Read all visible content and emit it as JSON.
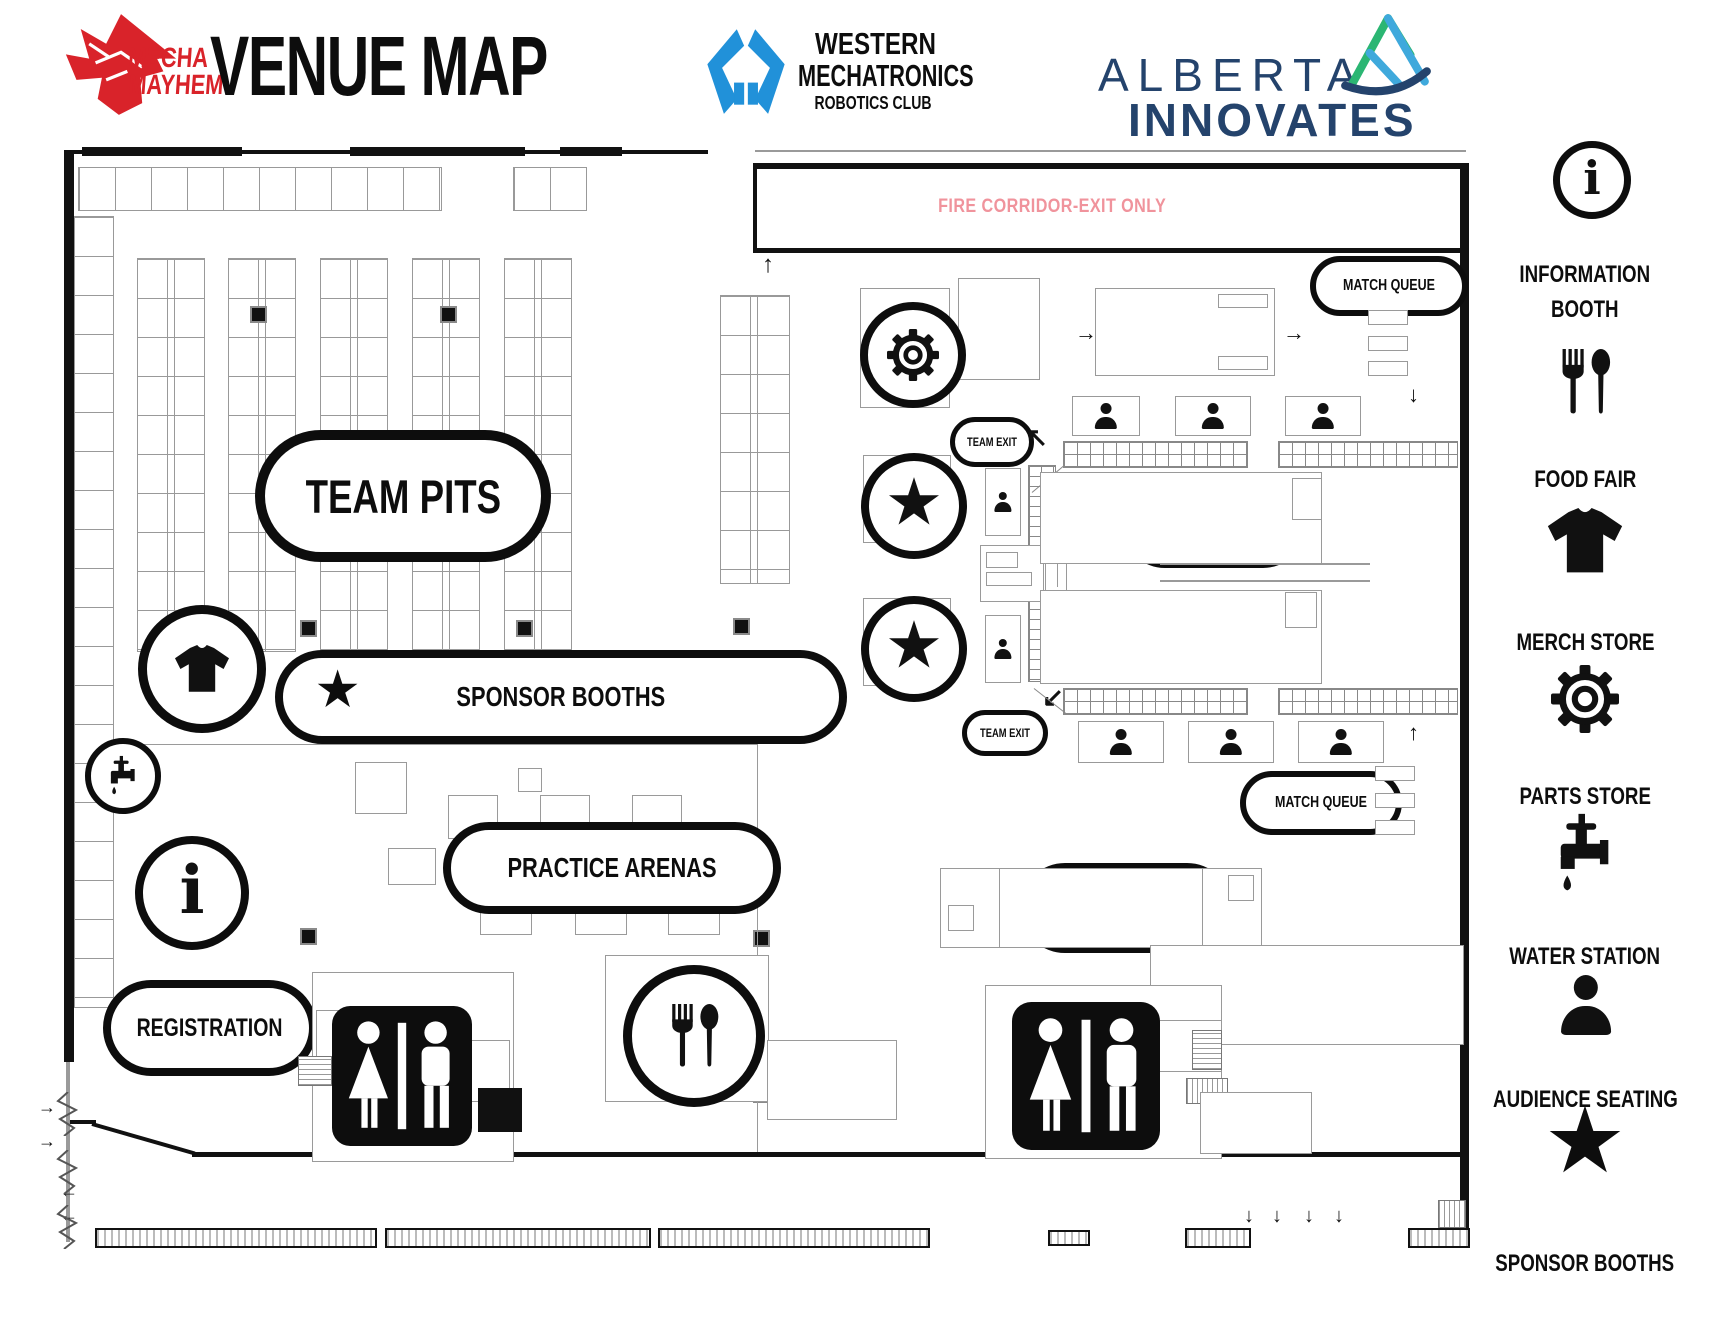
{
  "header": {
    "logo": {
      "line1": "MECHA",
      "line2": "MAYHEM"
    },
    "title": "VENUE MAP",
    "wm": {
      "line1": "WESTERN",
      "line2": "MECHATRONICS",
      "line3": "ROBOTICS CLUB"
    },
    "alberta": {
      "line1": "ALBERTA",
      "line2": "INNOVATES"
    }
  },
  "map": {
    "fire_corridor": "FIRE CORRIDOR-EXIT ONLY",
    "pills": {
      "team_pits": "TEAM PITS",
      "sponsor_booths": "SPONSOR BOOTHS",
      "practice_arenas": "PRACTICE ARENAS",
      "registration": "REGISTRATION",
      "inspection": "INSPECTION",
      "match_queue_top": "MATCH QUEUE",
      "match_queue_bottom": "MATCH QUEUE",
      "team_exit_top": "TEAM EXIT",
      "team_exit_bottom": "TEAM EXIT",
      "prairies": "PRAIRIES",
      "rockies": "ROCKIES",
      "skills": "SKILLS",
      "volunteers": "VOLUNTEERS",
      "food_fair": "FOOD FAIR"
    }
  },
  "legend": {
    "items": [
      {
        "icon": "information-icon",
        "label": "INFORMATION\nBOOTH"
      },
      {
        "icon": "food-fair-icon",
        "label": "FOOD FAIR"
      },
      {
        "icon": "merch-store-icon",
        "label": "MERCH STORE"
      },
      {
        "icon": "parts-store-icon",
        "label": "PARTS STORE"
      },
      {
        "icon": "water-station-icon",
        "label": "WATER STATION"
      },
      {
        "icon": "audience-seating-icon",
        "label": "AUDIENCE SEATING"
      },
      {
        "icon": "sponsor-booths-icon",
        "label": "SPONSOR BOOTHS"
      }
    ]
  },
  "icons": {
    "star": "★",
    "info": "i",
    "arrow_up": "↑",
    "arrow_down": "↓",
    "arrow_left": "←",
    "arrow_right": "→",
    "arrow_up_left": "↖",
    "arrow_down_left": "↙"
  },
  "colors": {
    "accent_red": "#d9232a",
    "accent_blue": "#2191d9",
    "navy": "#24436c",
    "corridor_pink": "#f0939c",
    "teal": "#2bb673",
    "light_blue": "#3fa9dc"
  }
}
